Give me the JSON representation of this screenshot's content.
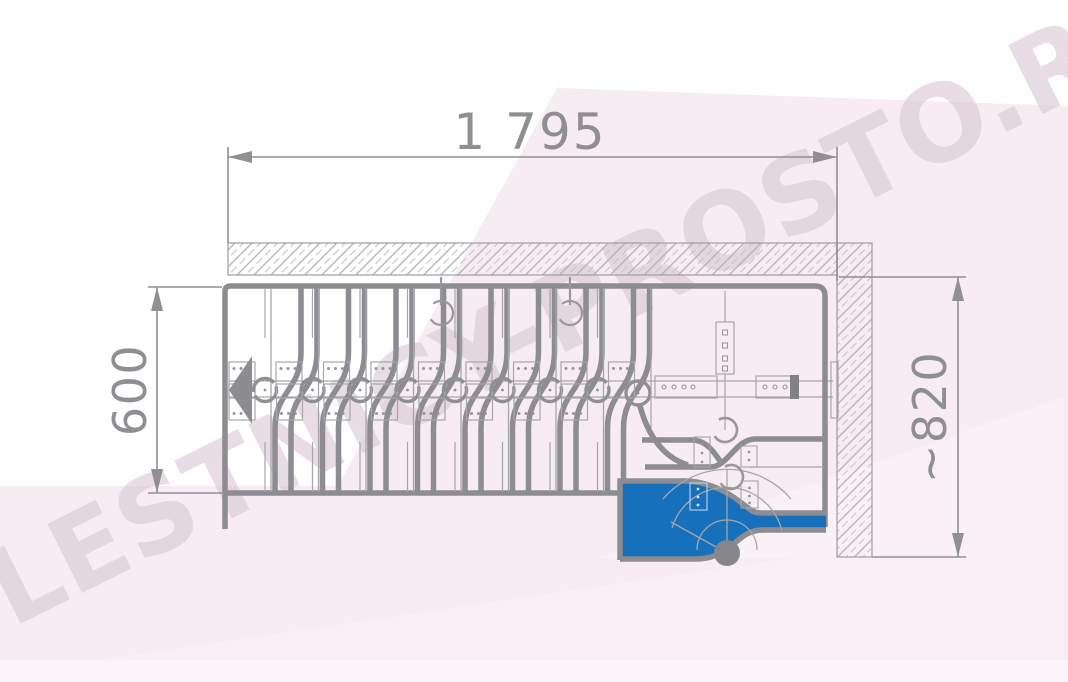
{
  "diagram": {
    "title": "folding-staircase-top-view-plan",
    "watermark": "LESTNICY-PROSTO.RU",
    "dimensions": {
      "width_top": {
        "value": "1 795",
        "orientation": "horizontal",
        "position": "top"
      },
      "depth_left": {
        "value": "600",
        "orientation": "vertical",
        "position": "left"
      },
      "depth_right": {
        "value": "~820",
        "orientation": "vertical",
        "position": "right"
      }
    },
    "colors": {
      "accent_blue": "#1670bc",
      "line_gray": "#8c8c91",
      "thin_gray": "#a6a6ab",
      "pole_gray": "#85858a",
      "background_pink": "#f7ecf2",
      "dimension_text": "#8e8e93"
    },
    "features": {
      "tread_units": 8,
      "hinge_circles": 9,
      "walls": [
        "top-wall-hatched",
        "right-wall-hatched"
      ],
      "platform": "blue-landing-platform-with-spiral-winder-steps",
      "direction_arrow": "points-left"
    }
  }
}
